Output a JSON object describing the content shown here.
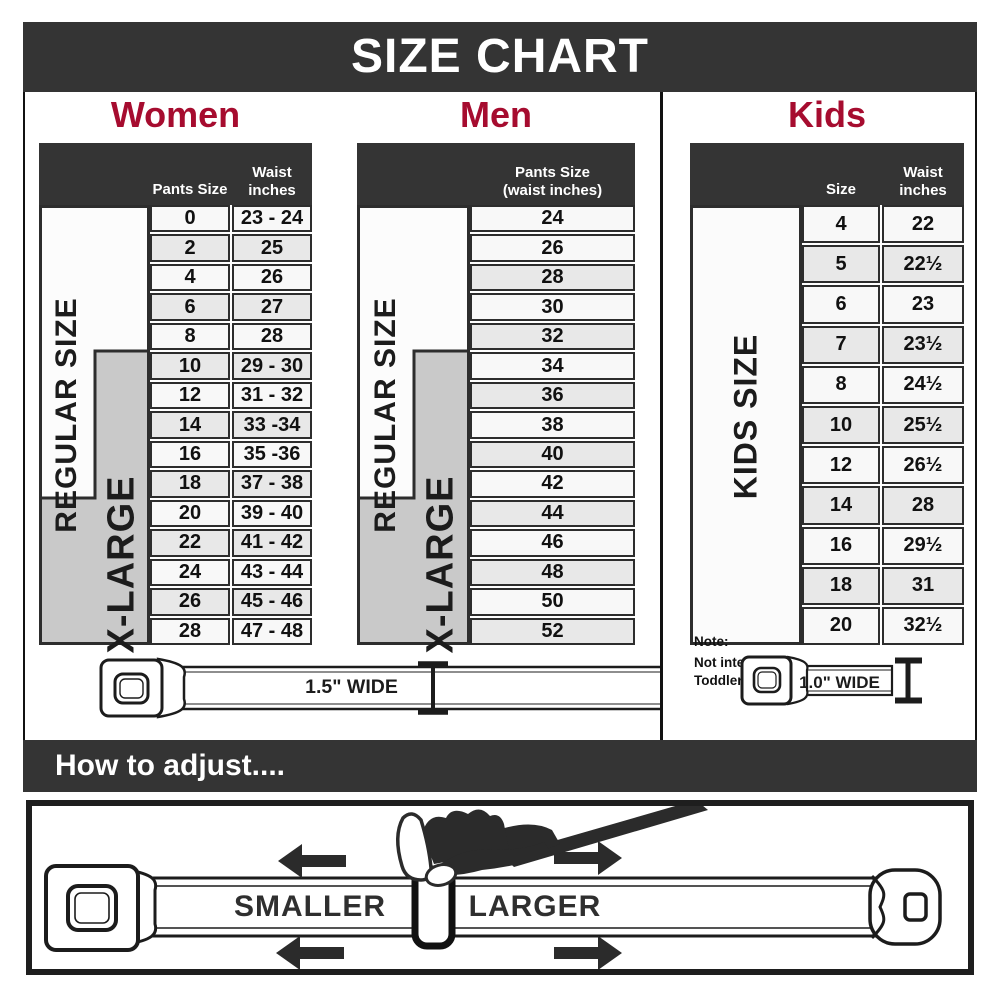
{
  "title": "SIZE CHART",
  "colors": {
    "accent_red": "#a60c2f",
    "bar_dark": "#343434",
    "row_light": "#f8f8f8",
    "row_shade": "#e8e8e8",
    "label_gray": "#c9c9c9"
  },
  "women": {
    "heading": "Women",
    "col1_header": "Pants Size",
    "col2_header": [
      "Waist",
      "inches"
    ],
    "regular_label": "REGULAR SIZE",
    "xlarge_label": "X-LARGE",
    "rows": [
      {
        "size": "0",
        "waist": "23 - 24"
      },
      {
        "size": "2",
        "waist": "25"
      },
      {
        "size": "4",
        "waist": "26"
      },
      {
        "size": "6",
        "waist": "27"
      },
      {
        "size": "8",
        "waist": "28"
      },
      {
        "size": "10",
        "waist": "29 - 30"
      },
      {
        "size": "12",
        "waist": "31 - 32"
      },
      {
        "size": "14",
        "waist": "33 -34"
      },
      {
        "size": "16",
        "waist": "35 -36"
      },
      {
        "size": "18",
        "waist": "37 - 38"
      },
      {
        "size": "20",
        "waist": "39 - 40"
      },
      {
        "size": "22",
        "waist": "41 - 42"
      },
      {
        "size": "24",
        "waist": "43 - 44"
      },
      {
        "size": "26",
        "waist": "45 - 46"
      },
      {
        "size": "28",
        "waist": "47 - 48"
      }
    ]
  },
  "men": {
    "heading": "Men",
    "col_header": [
      "Pants Size",
      "(waist inches)"
    ],
    "regular_label": "REGULAR SIZE",
    "xlarge_label": "X-LARGE",
    "rows": [
      "24",
      "26",
      "28",
      "30",
      "32",
      "34",
      "36",
      "38",
      "40",
      "42",
      "44",
      "46",
      "48",
      "50",
      "52"
    ]
  },
  "kids": {
    "heading": "Kids",
    "col1_header": "Size",
    "col2_header": [
      "Waist",
      "inches"
    ],
    "label": "KIDS SIZE",
    "note": [
      "Note:",
      "Not intended for",
      "Toddler Sizes (T)"
    ],
    "rows": [
      {
        "size": "4",
        "waist": "22"
      },
      {
        "size": "5",
        "waist": "22½"
      },
      {
        "size": "6",
        "waist": "23"
      },
      {
        "size": "7",
        "waist": "23½"
      },
      {
        "size": "8",
        "waist": "24½"
      },
      {
        "size": "10",
        "waist": "25½"
      },
      {
        "size": "12",
        "waist": "26½"
      },
      {
        "size": "14",
        "waist": "28"
      },
      {
        "size": "16",
        "waist": "29½"
      },
      {
        "size": "18",
        "waist": "31"
      },
      {
        "size": "20",
        "waist": "32½"
      }
    ]
  },
  "belts": {
    "adult_width": "1.5\" WIDE",
    "kids_width": "1.0\" WIDE"
  },
  "how_to": {
    "heading": "How to adjust....",
    "smaller": "SMALLER",
    "larger": "LARGER"
  }
}
